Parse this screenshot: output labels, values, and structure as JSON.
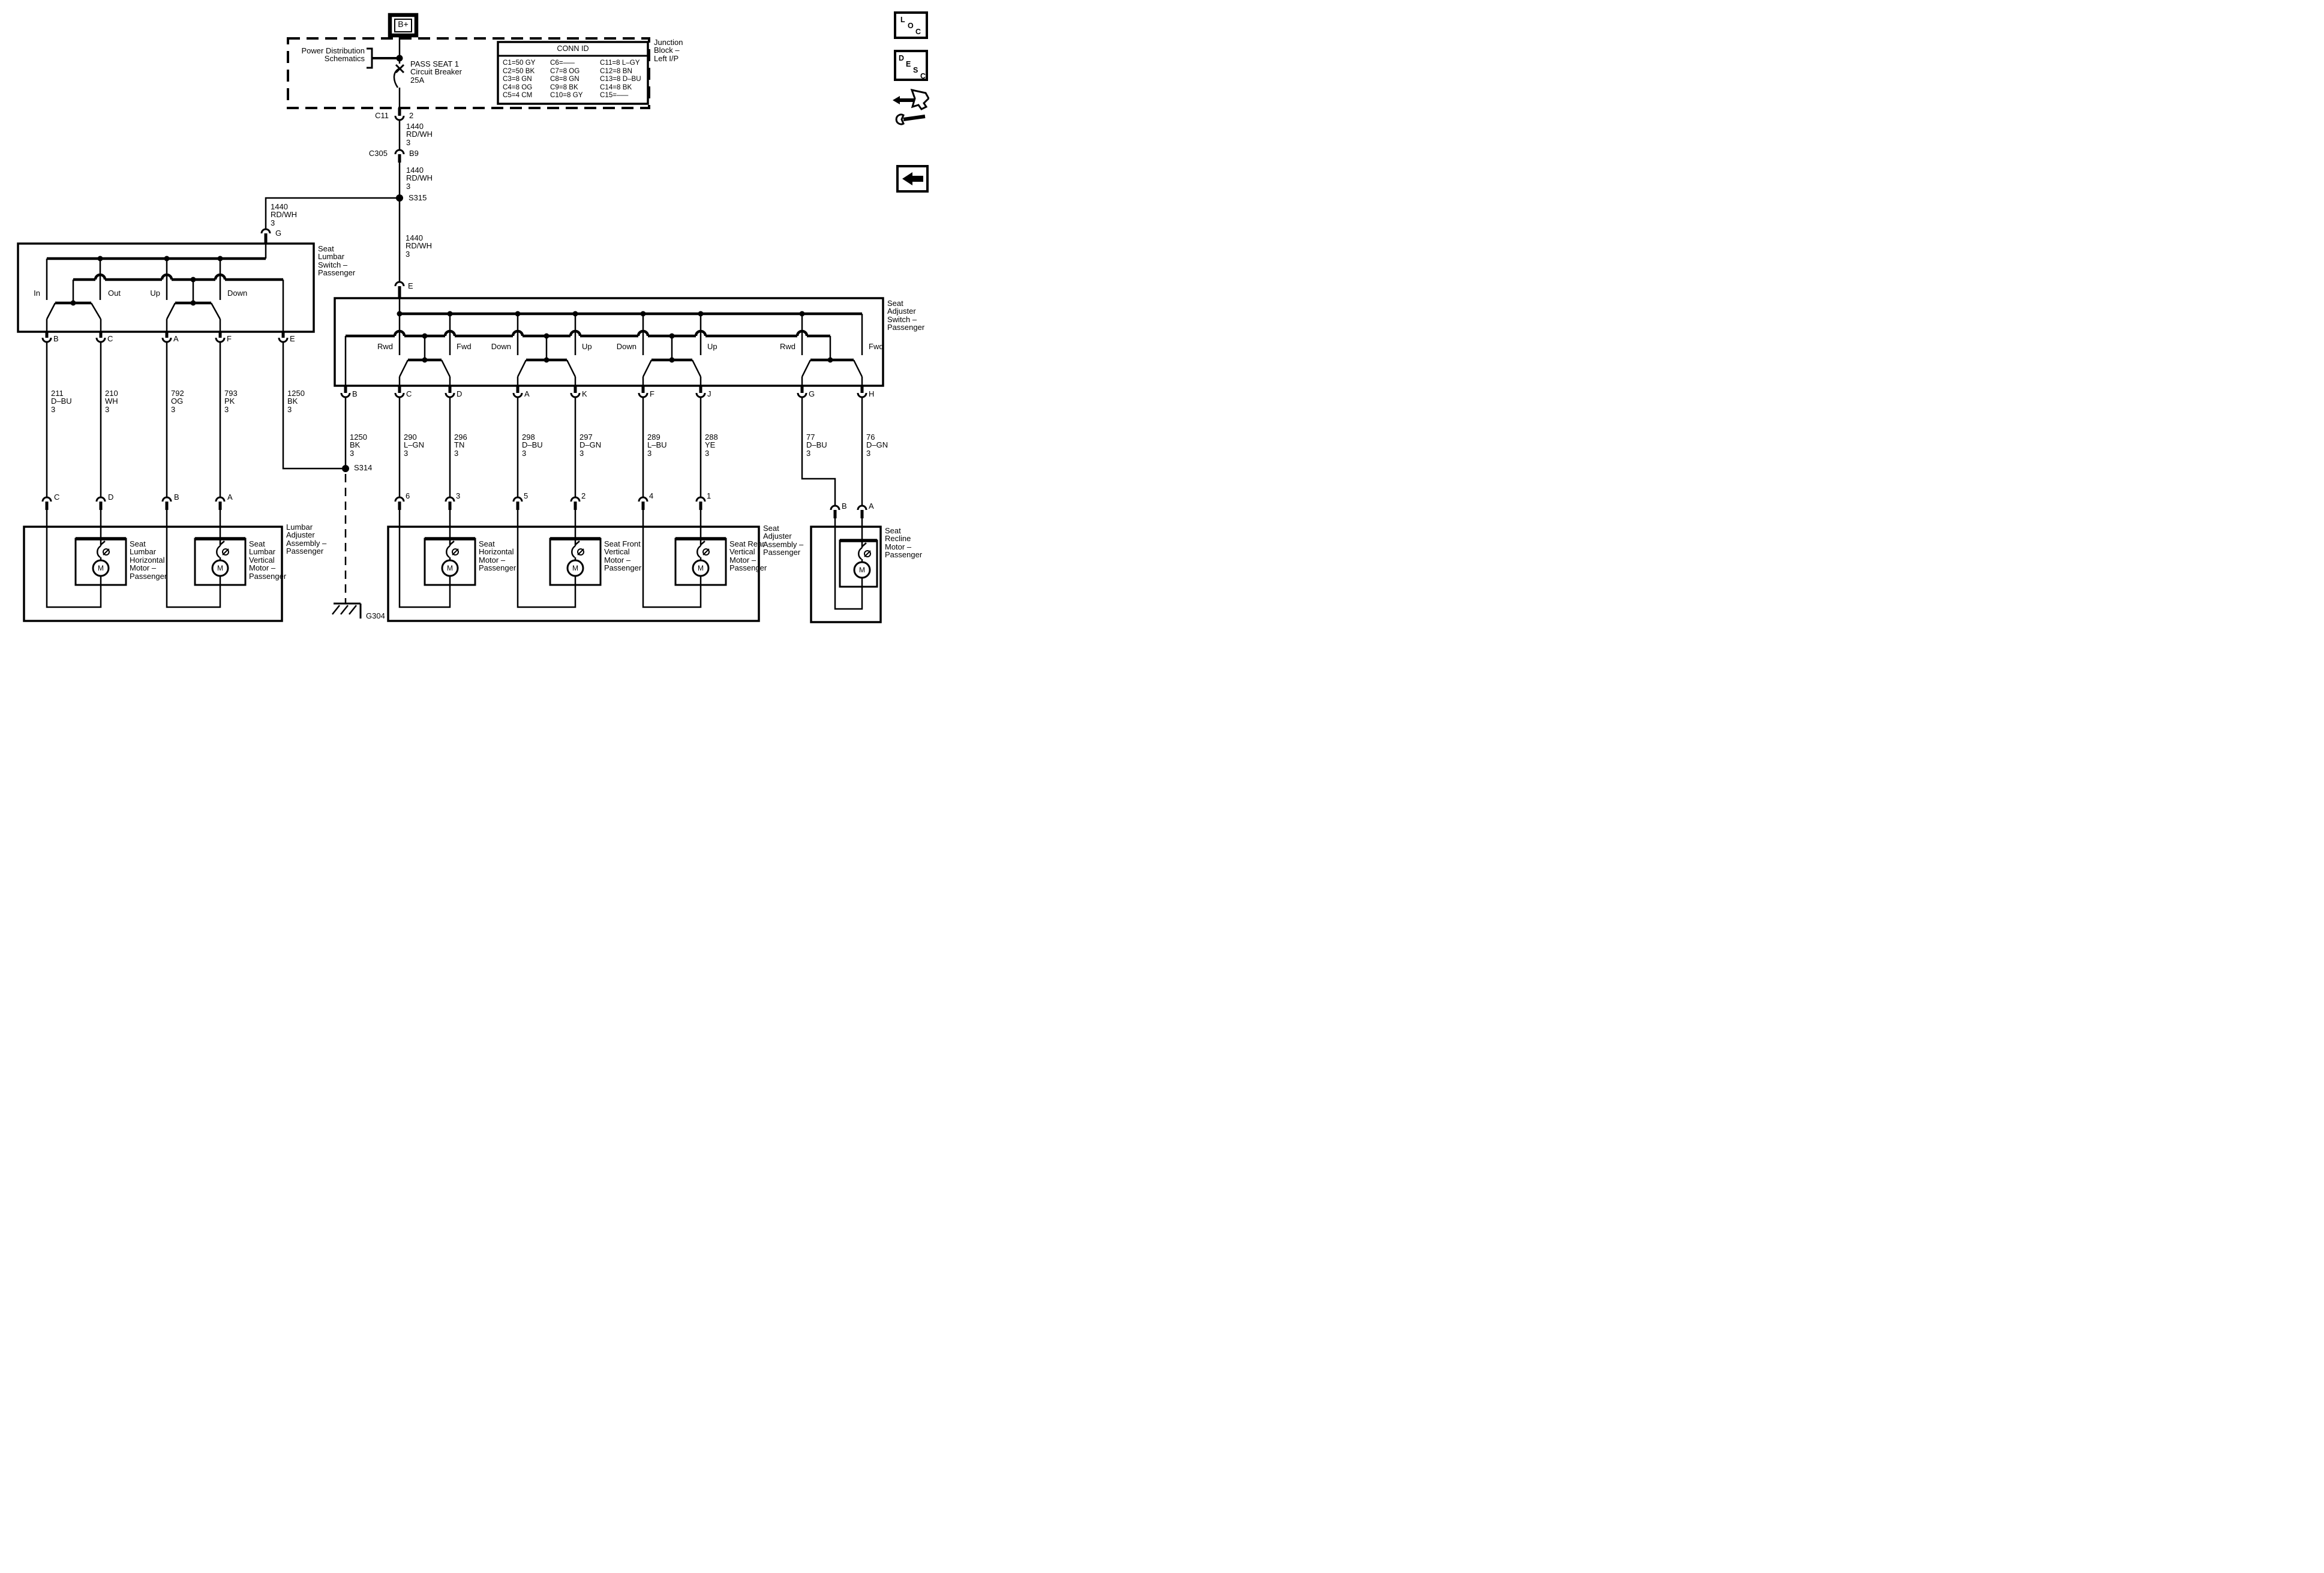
{
  "battery": {
    "label": "B+"
  },
  "junction_block": {
    "label": "Junction\nBlock –\nLeft I/P",
    "power_distribution": "Power Distribution\nSchematics",
    "breaker": "PASS SEAT 1\nCircuit Breaker\n25A",
    "conn_table": {
      "title": "CONN ID",
      "col1": "C1=50 GY\nC2=50 BK\nC3=8 GN\nC4=8 OG\nC5=4 CM",
      "col2": "C6=–––\nC7=8 OG\nC8=8 GN\nC9=8 BK\nC10=8 GY",
      "col3": "C11=8 L–GY\nC12=8 BN\nC13=8 D–BU\nC14=8 BK\nC15=–––"
    }
  },
  "feed": {
    "c11": "C11",
    "c11_pin": "2",
    "wire_c11": "1440\nRD/WH\n3",
    "c305": "C305",
    "c305_pin": "B9",
    "wire_c305": "1440\nRD/WH\n3",
    "s315": "S315",
    "wire_branch": "1440\nRD/WH\n3",
    "g_pin": "G",
    "wire_e": "1440\nRD/WH\n3",
    "e_pin": "E"
  },
  "lumbar_switch": {
    "title": "Seat\nLumbar\nSwitch –\nPassenger",
    "positions": [
      "In",
      "Out",
      "Up",
      "Down"
    ],
    "pins": [
      "B",
      "C",
      "A",
      "F",
      "E"
    ],
    "wires": [
      "211\nD–BU\n3",
      "210\nWH\n3",
      "792\nOG\n3",
      "793\nPK\n3",
      "1250\nBK\n3"
    ],
    "bottom_pins": [
      "C",
      "D",
      "B",
      "A"
    ]
  },
  "adjuster_switch": {
    "title": "Seat\nAdjuster\nSwitch –\nPassenger",
    "positions": [
      "Rwd",
      "Fwd",
      "Down",
      "Up",
      "Down",
      "Up",
      "Rwd",
      "Fwd"
    ],
    "pins": [
      "B",
      "C",
      "D",
      "A",
      "K",
      "F",
      "J",
      "G",
      "H"
    ],
    "wires": [
      "1250\nBK\n3",
      "290\nL–GN\n3",
      "296\nTN\n3",
      "298\nD–BU\n3",
      "297\nD–GN\n3",
      "289\nL–BU\n3",
      "288\nYE\n3",
      "77\nD–BU\n3",
      "76\nD–GN\n3"
    ],
    "bottom_pins": [
      "6",
      "3",
      "5",
      "2",
      "4",
      "1"
    ],
    "recline_pins": [
      "B",
      "A"
    ]
  },
  "grounds": {
    "s314": "S314",
    "g304": "G304"
  },
  "lumbar_assembly": {
    "title": "Lumbar\nAdjuster\nAssembly –\nPassenger",
    "motors": [
      "Seat\nLumbar\nHorizontal\nMotor –\nPassenger",
      "Seat\nLumbar\nVertical\nMotor –\nPassenger"
    ]
  },
  "adjuster_assembly": {
    "title": "Seat\nAdjuster\nAssembly –\nPassenger",
    "motors": [
      "Seat\nHorizontal\nMotor –\nPassenger",
      "Seat Front\nVertical\nMotor –\nPassenger",
      "Seat Rear\nVertical\nMotor –\nPassenger"
    ]
  },
  "recline": {
    "title": "Seat\nRecline\nMotor –\nPassenger"
  },
  "motor_symbol": "M",
  "sidebar": {
    "loc": [
      "L",
      "O",
      "C"
    ],
    "desc": [
      "D",
      "E",
      "S",
      "C"
    ]
  }
}
